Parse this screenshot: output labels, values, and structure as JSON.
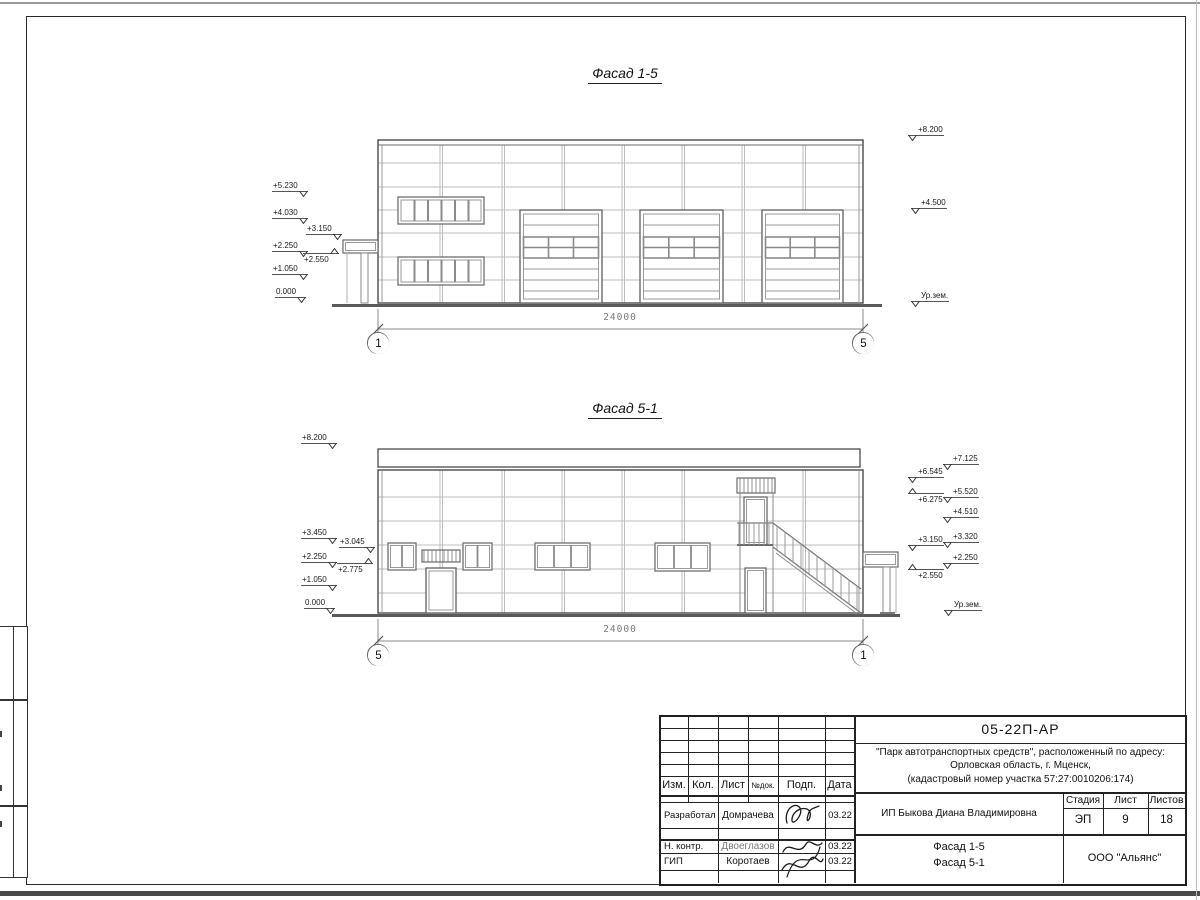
{
  "colors": {
    "line": "#4a4a4a",
    "joint": "#b8b8b8",
    "paper": "#ffffff"
  },
  "facade15": {
    "title": "Фасад 1-5",
    "dim": "24000",
    "axis_left": "1",
    "axis_right": "5",
    "markers_left": [
      "+5.230",
      "+4.030",
      "+3.150",
      "+2.250",
      "+2.550",
      "+1.050",
      "0.000"
    ],
    "markers_right": [
      "+8.200",
      "+4.500",
      "Ур.зем."
    ]
  },
  "facade51": {
    "title": "Фасад 5-1",
    "dim": "24000",
    "axis_left": "5",
    "axis_right": "1",
    "markers_left": [
      "+8.200",
      "+3.450",
      "+3.045",
      "+2.250",
      "+2.775",
      "+1.050",
      "0.000"
    ],
    "markers_right_inner": [
      "+6.545",
      "+6.275",
      "+3.150",
      "+2.550"
    ],
    "markers_right_outer": [
      "+7.125",
      "+5.520",
      "+4.510",
      "+3.320",
      "+2.250",
      "Ур.зем."
    ]
  },
  "titleblock": {
    "doc_code": "05-22П-АР",
    "project_line1": "\"Парк автотранспортных средств\",  расположенный по адресу:",
    "project_line2": "Орловская область, г. Мценск,",
    "project_line3": "(кадастровый номер участка 57:27:0010206:174)",
    "header_cols": [
      "Изм.",
      "Кол.",
      "Лист",
      "№док.",
      "Подп.",
      "Дата"
    ],
    "sign_rows": [
      {
        "role": "Разработал",
        "name": "Домрачева",
        "date": "03.22"
      },
      {
        "role": "Н. контр.",
        "name": "Двоеглазов",
        "date": "03.22"
      },
      {
        "role": "ГИП",
        "name": "Коротаев",
        "date": "03.22"
      }
    ],
    "client": "ИП Быкова Диана Владимировна",
    "stage_label": "Стадия",
    "sheet_label": "Лист",
    "sheets_label": "Листов",
    "stage": "ЭП",
    "sheet_num": "9",
    "sheets_total": "18",
    "drawing_title_line1": "Фасад 1-5",
    "drawing_title_line2": "Фасад 5-1",
    "company": "ООО \"Альянс\""
  }
}
